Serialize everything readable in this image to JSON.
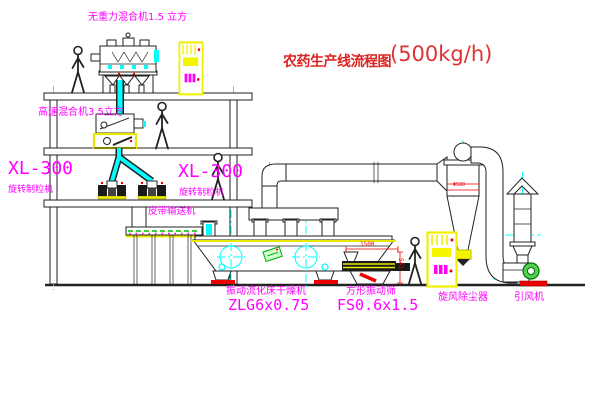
{
  "title": {
    "name": "农药生产线流程图",
    "capacity": "(500kg/h)"
  },
  "labels": {
    "top_mixer": "无重力混合机1.5 立方",
    "floor2_mixer": "高速混合机3.5立方",
    "granulator_left_model": "XL-300",
    "granulator_left_name": "旋转制粒机",
    "granulator_mid_model": "XL-300",
    "granulator_mid_name": "旋转制粒机",
    "belt_conveyor": "皮带输送机",
    "dryer_name": "振动流化床干燥机",
    "dryer_model": "ZLG6x0.75",
    "sieve_name": "方形振动筛",
    "sieve_model": "FS0.6x1.5",
    "cyclone": "旋风除尘器",
    "fan": "引风机"
  },
  "dimensions": {
    "sieve_length": "1500",
    "sieve_height": "541",
    "cyclone_marking": "Φ500"
  },
  "colors": {
    "label_magenta": "#ff00ff",
    "title_red": "#dd2222",
    "centerline_cyan": "#00ffff",
    "highlight_yellow": "#f0f000",
    "line_dark": "#222222",
    "accent_green": "#00aa00",
    "accent_red": "#ee0000"
  }
}
